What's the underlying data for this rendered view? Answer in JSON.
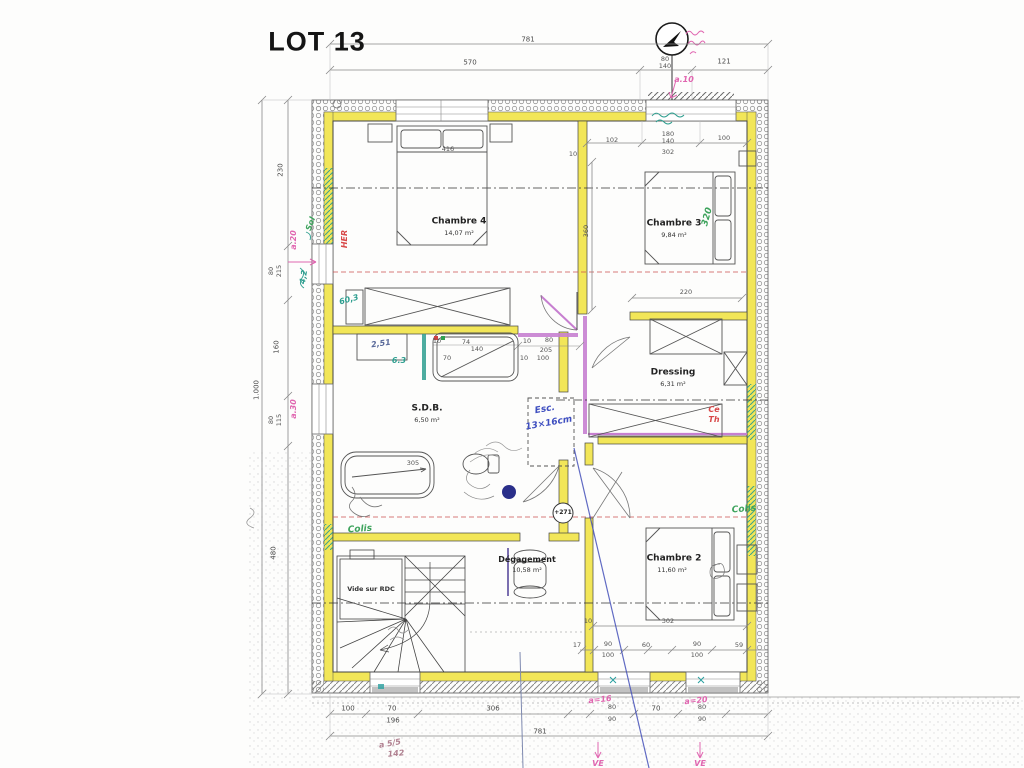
{
  "colors": {
    "wall-yellow": "#f2e658",
    "violet": "#c77fd0",
    "pink": "#e066b0",
    "green": "#3da35c",
    "teal": "#2e9e8f",
    "red": "#d84848",
    "blue": "#3f4fc0",
    "navy": "#2a2f8a"
  },
  "title": "LOT 13",
  "rooms": {
    "chambre4": {
      "name": "Chambre 4",
      "area": "14,07 m²"
    },
    "chambre3": {
      "name": "Chambre 3",
      "area": "9,84 m²"
    },
    "chambre2": {
      "name": "Chambre 2",
      "area": "11,60 m²"
    },
    "dressing": {
      "name": "Dressing",
      "area": "6,31 m²"
    },
    "sdb": {
      "name": "S.D.B.",
      "area": "6,50 m²"
    },
    "degagement": {
      "name": "Dégagement",
      "area": "10,58 m²"
    },
    "vide": {
      "name": "Vide sur RDC"
    }
  },
  "markers": {
    "level": "+271"
  },
  "dims": {
    "top": {
      "overall": "781",
      "main": "570",
      "h80": "80",
      "h140": "140",
      "d121": "121"
    },
    "left": {
      "overall": "1.000",
      "d230": "230",
      "d80a": "80",
      "d215": "215",
      "d160": "160",
      "d80b": "80",
      "d115": "115",
      "d480": "480"
    },
    "bottom": {
      "overall": "781",
      "d100": "100",
      "d70a": "70",
      "d196": "196",
      "d306": "306",
      "d80a": "80",
      "d90a": "90",
      "d70b": "70",
      "d80b": "80",
      "d90b": "90"
    },
    "interior": {
      "bed4": "416",
      "w102": "102",
      "w180": "180",
      "w140": "140",
      "w302": "302",
      "w100": "100",
      "d10a": "10",
      "d360": "360",
      "d220": "220",
      "door10a": "10",
      "door80": "80",
      "door205": "205",
      "door10b": "10",
      "door100": "100",
      "van10": "10",
      "van74": "74",
      "van140": "140",
      "van70": "70",
      "tub305": "305",
      "c2d10": "10",
      "c2d302": "302",
      "c2d17": "17",
      "c2d90a": "90",
      "c2d100a": "100",
      "c2d60": "60",
      "c2d90b": "90",
      "c2d100b": "100",
      "c2d59": "59"
    }
  },
  "annotations": {
    "pink": {
      "a10": "a.10",
      "a20": "a.20",
      "a30": "a.30",
      "a16": "a=16",
      "a20b": "a=20",
      "ve1": "VE",
      "ve2": "VE",
      "c55": "a 5/5",
      "c142": "142"
    },
    "green": {
      "colis1": "Colis",
      "colis2": "Colis",
      "sol": "Sol",
      "r320": "320"
    },
    "teal": {
      "n63": "6.3",
      "n603": "60,3",
      "n42": "4,2"
    },
    "red": {
      "her": "HER",
      "ce": "Ce",
      "th": "Th"
    },
    "blue": {
      "esc": "Esc.",
      "esc2": "13×16cm",
      "n251": "2,51"
    }
  }
}
